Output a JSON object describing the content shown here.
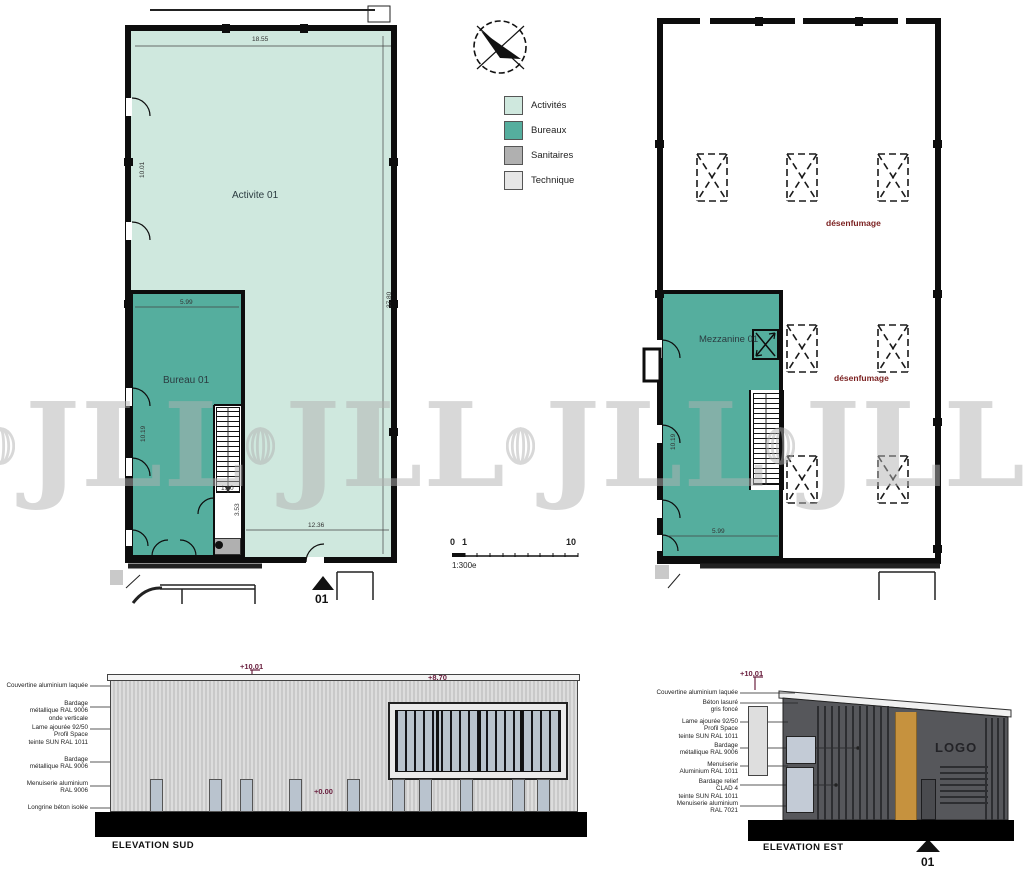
{
  "colors": {
    "activites": "#cfe8de",
    "bureaux": "#55ae9e",
    "sanitaires": "#b0b0b0",
    "technique": "#e6e6e6",
    "smoke_text": "#7a1f1f",
    "level_text": "#6b2140",
    "est_facade": "#56575b",
    "est_accent": "#c6923e"
  },
  "legend": {
    "items": [
      {
        "label": "Activités",
        "color": "#cfe8de"
      },
      {
        "label": "Bureaux",
        "color": "#55ae9e"
      },
      {
        "label": "Sanitaires",
        "color": "#b0b0b0"
      },
      {
        "label": "Technique",
        "color": "#e6e6e6"
      }
    ]
  },
  "plan_ground": {
    "room_activity": "Activite 01",
    "room_bureau": "Bureau 01",
    "dims": {
      "top": "18.55",
      "right": "37.80",
      "bottom": "12.36",
      "bureau_width": "5.99",
      "stair": "1.80",
      "corridor": "3.53",
      "left": "10.01",
      "bureau_depth": "10.19"
    },
    "marker": "01"
  },
  "plan_mezzanine": {
    "room": "Mezzanine 01",
    "smoke_label_1": "désenfumage",
    "smoke_label_2": "désenfumage",
    "dims": {
      "width": "5.99",
      "depth": "10.19"
    }
  },
  "scalebar": {
    "zero": "0",
    "one": "1",
    "ten": "10",
    "ratio": "1:300e"
  },
  "elevation_sud": {
    "title": "ELEVATION SUD",
    "levels": {
      "top": "+10.01",
      "mid": "+8.70",
      "ground": "+0.00"
    },
    "annotations": [
      "Couvertine aluminium laquée",
      "Bardage\nmétallique RAL 9006\nonde verticale",
      "Lame ajourée 92/50\nProfil Space\nteinte SUN RAL 1011",
      "Bardage\nmétallique RAL 9006",
      "Menuiserie aluminium\nRAL 9006",
      "Longrine béton isolée"
    ]
  },
  "elevation_est": {
    "title": "ELEVATION EST",
    "level": "+10.01",
    "logo": "LOGO",
    "marker": "01",
    "annotations": [
      "Couvertine aluminium laquée",
      "Béton lasuré\ngris foncé",
      "Lame ajourée 92/50\nProfil Space\nteinte SUN RAL 1011",
      "Bardage\nmétallique RAL 9006",
      "Menuiserie\nAluminium RAL 1011",
      "Bardage relief\nCLAD 4\nteinte SUN RAL 1011",
      "Menuiserie aluminium\nRAL 7021"
    ]
  },
  "watermark": {
    "text": "JLL"
  }
}
